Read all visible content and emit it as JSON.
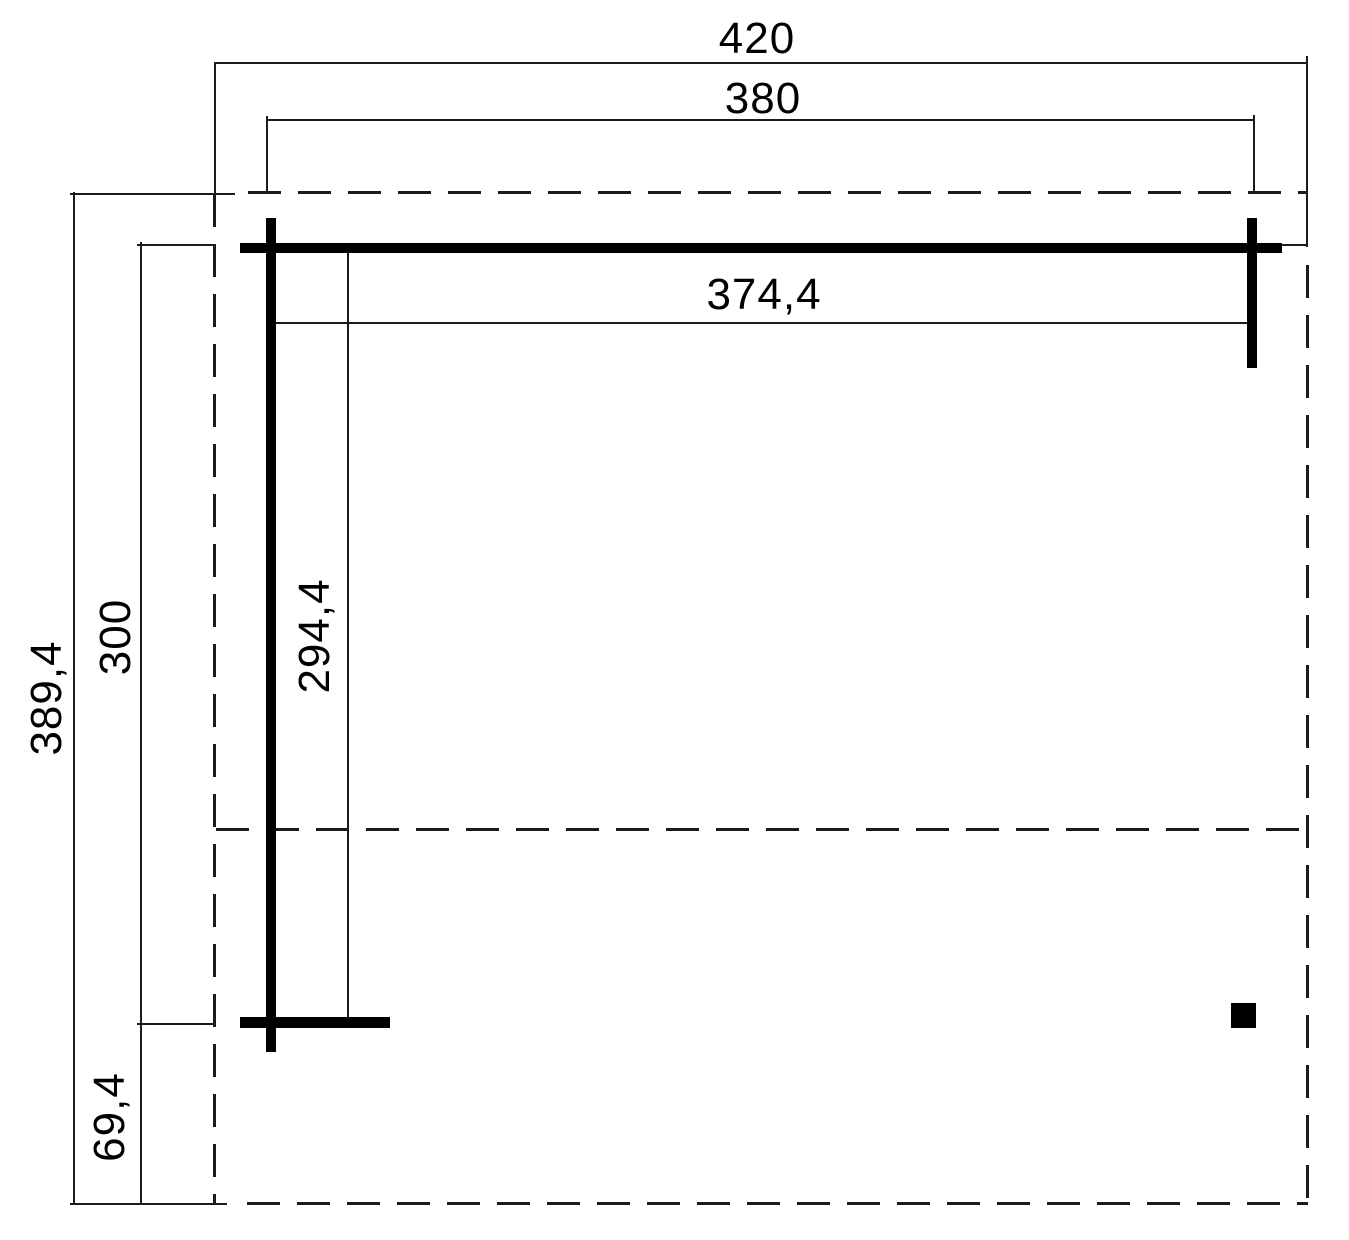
{
  "diagram": {
    "type": "floor-plan-technical-drawing",
    "dimension_labels": {
      "roof_width": "420",
      "post_span_width": "380",
      "clear_width": "374,4",
      "roof_depth": "389,4",
      "post_span_depth": "300",
      "clear_depth": "294,4",
      "rear_overhang_depth": "69,4"
    },
    "colors": {
      "background": "#ffffff",
      "line": "#1b1b1b",
      "wall_fill": "#000000",
      "text": "#000000"
    }
  }
}
